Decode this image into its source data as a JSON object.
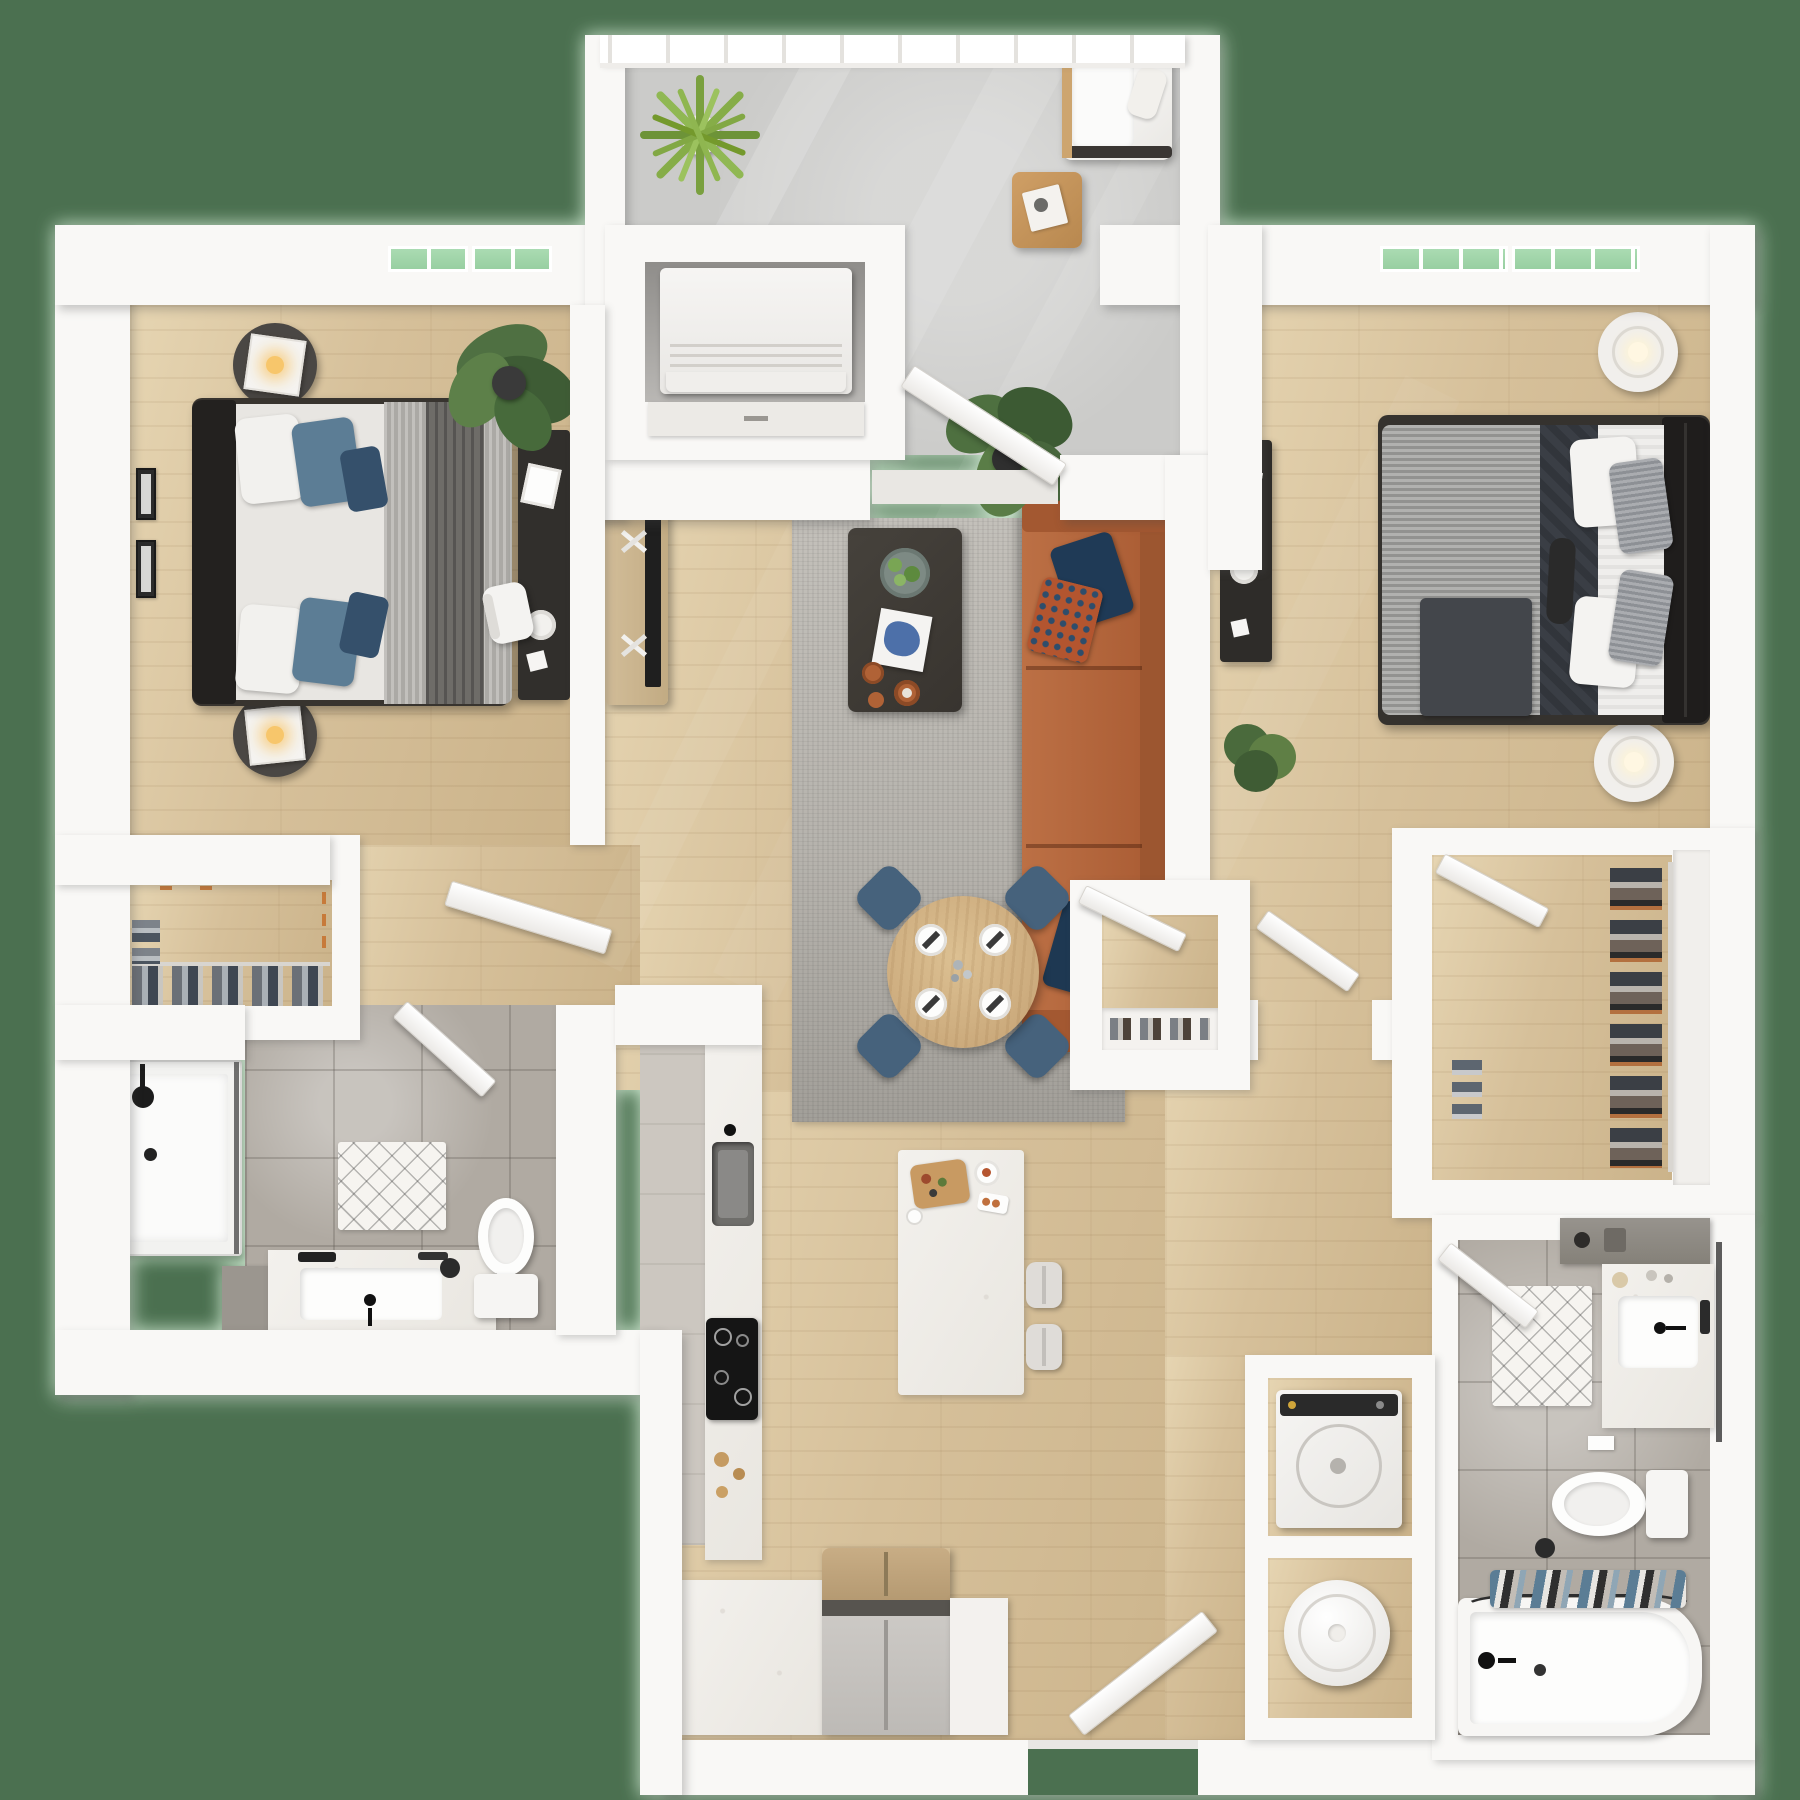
{
  "scene": {
    "kind": "3d-top-down-floor-plan",
    "description": "Two bedroom / two bathroom apartment 3D floor plan render, top view, no text labels",
    "rooms": [
      {
        "name": "balcony",
        "floor": "concrete",
        "furniture": [
          "spiky-potted-plant",
          "white-lounge-chair",
          "wood-side-table",
          "railing"
        ]
      },
      {
        "name": "bedroom-1",
        "floor": "wood",
        "furniture": [
          "queen-bed-gray-bedding",
          "two-round-nightstands-with-lamps",
          "black-desk-with-white-chair",
          "monstera-plant",
          "wall-picture-frames",
          "window"
        ]
      },
      {
        "name": "bedroom-2",
        "floor": "wood",
        "furniture": [
          "queen-bed-striped-gray-bedding-black-headboard",
          "two-white-cylinder-lamps",
          "black-desk",
          "shrub-plant",
          "wall-picture-frames",
          "window"
        ]
      },
      {
        "name": "living-room",
        "floor": "wood",
        "furniture": [
          "cognac-leather-sofa-navy-pillows",
          "gray-area-rug",
          "dark-coffee-table-with-tray-book-mugs",
          "tv-media-console",
          "fiddle-leaf-plant"
        ]
      },
      {
        "name": "dining-area",
        "floor": "wood",
        "furniture": [
          "round-wood-table",
          "four-blue-chairs",
          "four-place-settings"
        ]
      },
      {
        "name": "kitchen",
        "floor": "gray",
        "furniture": [
          "counter-with-sink",
          "black-cooktop",
          "refrigerator",
          "white-island-with-two-stools",
          "cutting-board"
        ]
      },
      {
        "name": "bathroom-1",
        "floor": "tile",
        "furniture": [
          "glass-shower",
          "vanity-with-black-faucet",
          "toilet",
          "diamond-bath-mat"
        ]
      },
      {
        "name": "bathroom-2",
        "floor": "tile",
        "furniture": [
          "vanity-with-black-faucet",
          "toilet",
          "bathtub-with-caddy",
          "diamond-bath-mat",
          "dark-counter"
        ]
      },
      {
        "name": "walk-in-closet",
        "floor": "wood",
        "furniture": [
          "hanging-clothes-rack"
        ]
      },
      {
        "name": "entry-closet",
        "floor": "wood",
        "furniture": [
          "hanging-clothes",
          "orange-hooks"
        ]
      },
      {
        "name": "hall-closet",
        "floor": "wood",
        "furniture": [
          "shelf-with-shoes"
        ]
      },
      {
        "name": "utility-alcove",
        "furniture": [
          "white-cabinet-unit",
          "sliding-door"
        ]
      },
      {
        "name": "laundry-closet",
        "furniture": [
          "top-load-washer",
          "water-heater-cylinder"
        ]
      }
    ],
    "doors_open": 9,
    "windows": 4
  },
  "colors": {
    "bg": "#4b7050",
    "wall": "#f9f8f6",
    "wood": "#d6c09a",
    "tile": "#b0aaa2",
    "concrete": "#cbcbc9",
    "glass": "#aadbb2",
    "rug": "#bab7b1",
    "sofa": "#b2653c",
    "navy": "#1f3a56",
    "chair_blue": "#46627c",
    "table_wood": "#d3b586",
    "blanket_gray": "#9b9b99",
    "dark_furniture": "#2f2d2b",
    "copper": "#b06236",
    "leaf_green": "#4e7040"
  }
}
